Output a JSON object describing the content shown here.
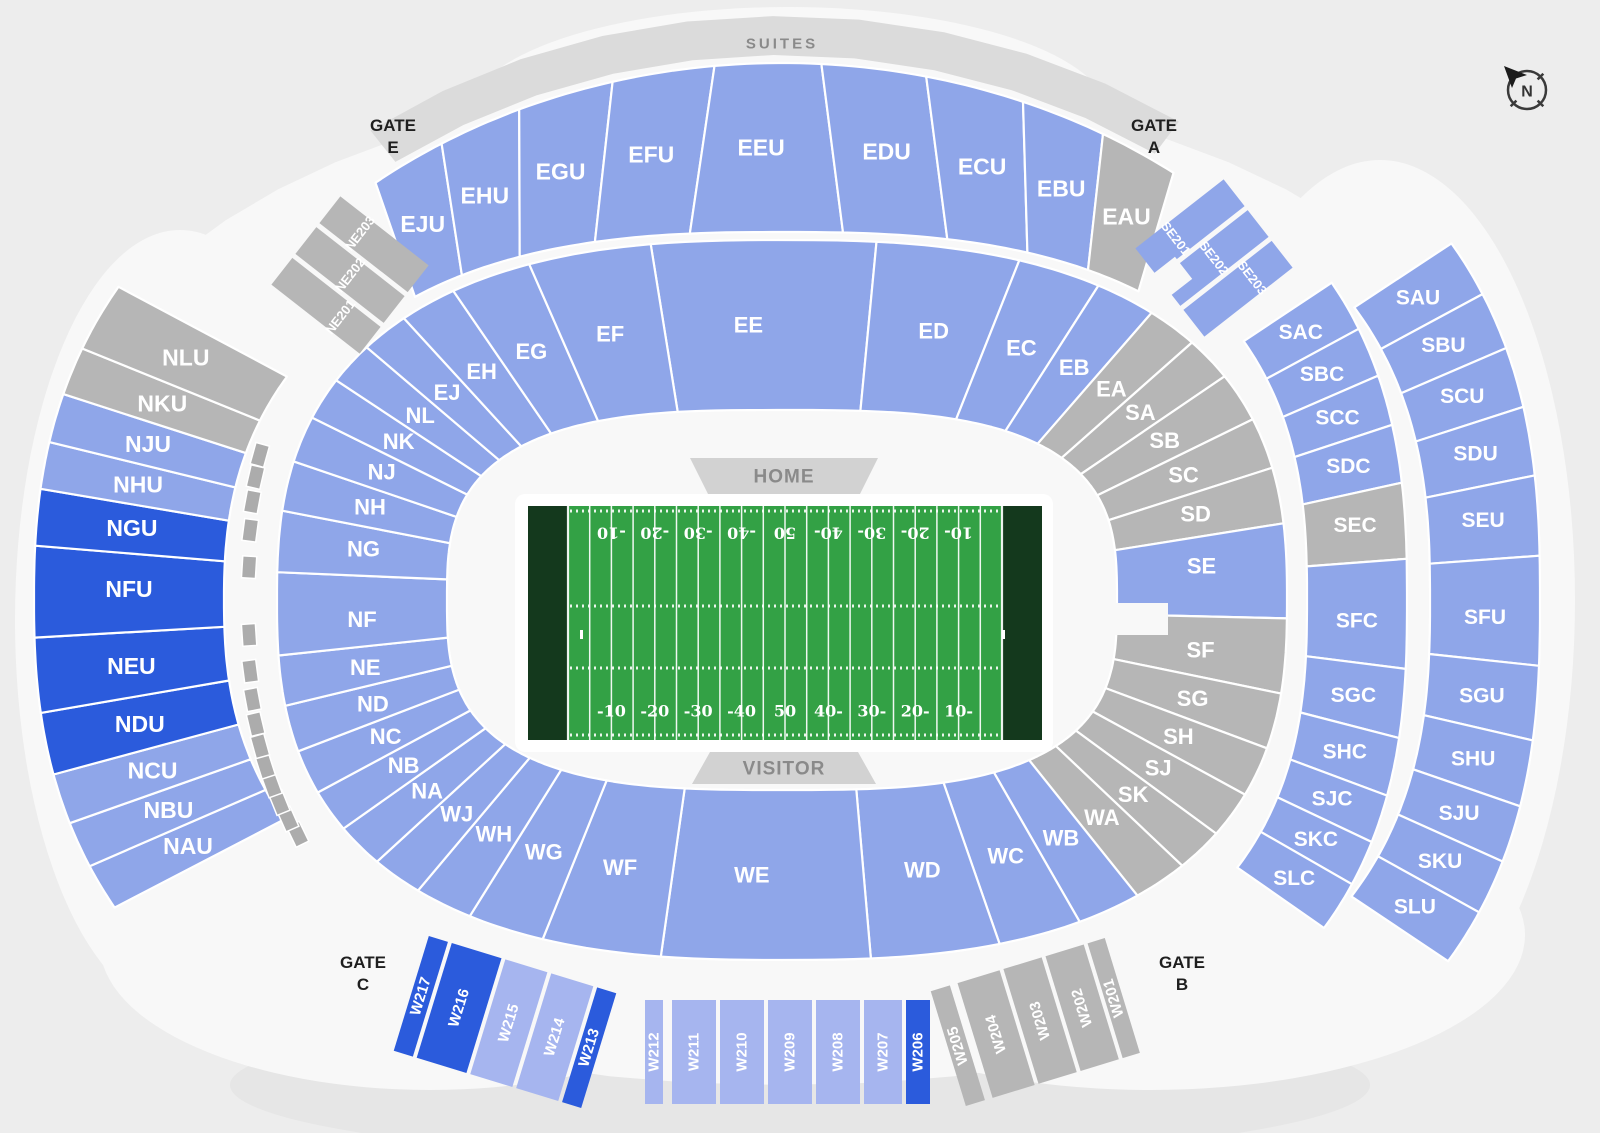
{
  "colors": {
    "light": "#8FA6E9",
    "light2": "#A6B5EF",
    "dark": "#2B5BDC",
    "gray": "#B6B6B6",
    "mini_box": "#ACACAC",
    "suites_band": "#DBDBDB",
    "tag_bg": "#D2D2D2",
    "tag_text": "#8A8A8A",
    "footprint": "#F8F8F8",
    "page_bg": "#EDEDED",
    "field_green": "#33A145",
    "end_zone_green": "#14391D",
    "gate_text": "#1F1F1F",
    "compass_color": "#333333"
  },
  "compass": {
    "label": "N"
  },
  "suites": {
    "label": "SUITES"
  },
  "gates": {
    "e": {
      "word": "GATE",
      "letter": "E"
    },
    "a": {
      "word": "GATE",
      "letter": "A"
    },
    "c": {
      "word": "GATE",
      "letter": "C"
    },
    "b": {
      "word": "GATE",
      "letter": "B"
    }
  },
  "field": {
    "home_label": "HOME",
    "visitor_label": "VISITOR",
    "yard_numbers_bottom": [
      "-10",
      "-20",
      "-30",
      "-40",
      "50",
      "40-",
      "30-",
      "20-",
      "10-"
    ],
    "yard_numbers_top": [
      "-10",
      "-20",
      "-30",
      "-40",
      "50",
      "40-",
      "30-",
      "20-",
      "10-"
    ]
  },
  "sections": {
    "EJ": "EJ",
    "EH": "EH",
    "EG": "EG",
    "EF": "EF",
    "EE": "EE",
    "ED": "ED",
    "EC": "EC",
    "EB": "EB",
    "EA": "EA",
    "SA": "SA",
    "SB": "SB",
    "SC": "SC",
    "SD": "SD",
    "SE": "SE",
    "SF": "SF",
    "SG": "SG",
    "SH": "SH",
    "SJ": "SJ",
    "SK": "SK",
    "WA": "WA",
    "WB": "WB",
    "WC": "WC",
    "WD": "WD",
    "WE": "WE",
    "WF": "WF",
    "WG": "WG",
    "WH": "WH",
    "WJ": "WJ",
    "NA": "NA",
    "NB": "NB",
    "NC": "NC",
    "ND": "ND",
    "NE": "NE",
    "NF": "NF",
    "NG": "NG",
    "NH": "NH",
    "NJ": "NJ",
    "NK": "NK",
    "NL": "NL",
    "EJU": "EJU",
    "EHU": "EHU",
    "EGU": "EGU",
    "EFU": "EFU",
    "EEU": "EEU",
    "EDU": "EDU",
    "ECU": "ECU",
    "EBU": "EBU",
    "EAU": "EAU",
    "NLU": "NLU",
    "NKU": "NKU",
    "NJU": "NJU",
    "NHU": "NHU",
    "NGU": "NGU",
    "NFU": "NFU",
    "NEU": "NEU",
    "NDU": "NDU",
    "NCU": "NCU",
    "NBU": "NBU",
    "NAU": "NAU",
    "SAC": "SAC",
    "SBC": "SBC",
    "SCC": "SCC",
    "SDC": "SDC",
    "SEC": "SEC",
    "SFC": "SFC",
    "SGC": "SGC",
    "SHC": "SHC",
    "SJC": "SJC",
    "SKC": "SKC",
    "SLC": "SLC",
    "SAU": "SAU",
    "SBU": "SBU",
    "SCU": "SCU",
    "SDU": "SDU",
    "SEU": "SEU",
    "SFU": "SFU",
    "SGU": "SGU",
    "SHU": "SHU",
    "SJU": "SJU",
    "SKU": "SKU",
    "SLU": "SLU",
    "NE201": "NE201",
    "NE202": "NE202",
    "NE203": "NE203",
    "SE201": "SE201",
    "SE202": "SE202",
    "SE203": "SE203",
    "W201": "W201",
    "W202": "W202",
    "W203": "W203",
    "W204": "W204",
    "W205": "W205",
    "W206": "W206",
    "W207": "W207",
    "W208": "W208",
    "W209": "W209",
    "W210": "W210",
    "W211": "W211",
    "W212": "W212",
    "W213": "W213",
    "W214": "W214",
    "W215": "W215",
    "W216": "W216",
    "W217": "W217"
  }
}
